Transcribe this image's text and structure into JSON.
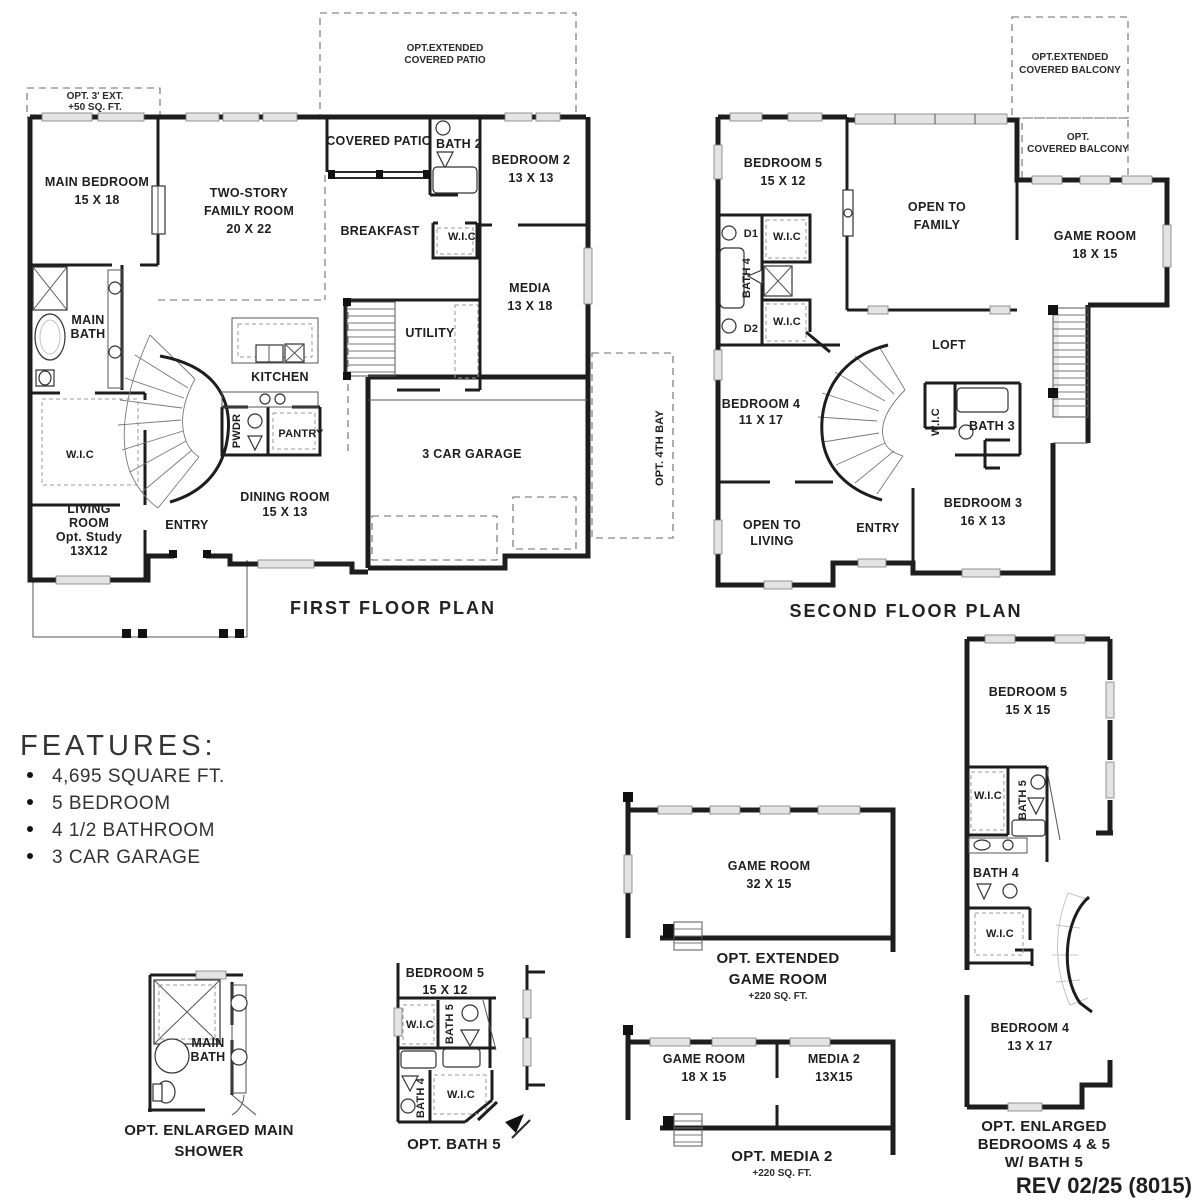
{
  "sheet": {
    "revision": "REV 02/25 (8015)",
    "wall_color": "#1d1d1d",
    "bg_color": "#ffffff"
  },
  "features": {
    "heading": "FEATURES:",
    "items": [
      "4,695 SQUARE FT.",
      "5 BEDROOM",
      "4 1/2 BATHROOM",
      "3 CAR GARAGE"
    ]
  },
  "first_floor": {
    "title": "FIRST FLOOR PLAN",
    "opt_ext": {
      "l1": "OPT. 3' EXT.",
      "l2": "+50 SQ. FT."
    },
    "opt_patio": {
      "l1": "OPT.EXTENDED",
      "l2": "COVERED PATIO"
    },
    "covered_patio": "COVERED PATIO",
    "bath2": "BATH 2",
    "bedroom2": {
      "name": "BEDROOM 2",
      "dim": "13 X 13"
    },
    "main_bedroom": {
      "name": "MAIN BEDROOM",
      "dim": "15 X 18"
    },
    "family_room": {
      "l1": "TWO-STORY",
      "l2": "FAMILY ROOM",
      "dim": "20 X 22"
    },
    "breakfast": "BREAKFAST",
    "wic_bed2": "W.I.C",
    "media": {
      "name": "MEDIA",
      "dim": "13 X 18"
    },
    "utility": "UTILITY",
    "main_bath": {
      "l1": "MAIN",
      "l2": "BATH"
    },
    "kitchen": "KITCHEN",
    "pwdr": "PWDR",
    "pantry": "PANTRY",
    "wic_main": "W.I.C",
    "living": {
      "l1": "LIVING",
      "l2": "ROOM",
      "l3": "Opt. Study",
      "l4": "13X12"
    },
    "entry": "ENTRY",
    "dining": {
      "name": "DINING ROOM",
      "dim": "15 X 13"
    },
    "garage": "3 CAR GARAGE",
    "opt_4th_bay": "OPT. 4TH BAY"
  },
  "second_floor": {
    "title": "SECOND FLOOR PLAN",
    "opt_ext_balcony": {
      "l1": "OPT.EXTENDED",
      "l2": "COVERED BALCONY"
    },
    "opt_balcony": {
      "l1": "OPT.",
      "l2": "COVERED BALCONY"
    },
    "bedroom5": {
      "name": "BEDROOM 5",
      "dim": "15 X 12"
    },
    "open_family": {
      "l1": "OPEN TO",
      "l2": "FAMILY"
    },
    "game_room": {
      "name": "GAME ROOM",
      "dim": "18 X 15"
    },
    "d1": "D1",
    "d2": "D2",
    "bath4": "BATH 4",
    "wic_top": "W.I.C",
    "wic_bottom": "W.I.C",
    "loft": "LOFT",
    "bedroom4": {
      "name": "BEDROOM 4",
      "dim": "11 X 17"
    },
    "open_living": {
      "l1": "OPEN TO",
      "l2": "LIVING"
    },
    "entry": "ENTRY",
    "wic_bed3": "W.I.C",
    "bath3": "BATH 3",
    "bedroom3": {
      "name": "BEDROOM 3",
      "dim": "16 X 13"
    }
  },
  "opt_main_shower": {
    "main_bath": {
      "l1": "MAIN",
      "l2": "BATH"
    },
    "caption": {
      "l1": "OPT. ENLARGED MAIN",
      "l2": "SHOWER"
    }
  },
  "opt_bath5": {
    "bedroom5": {
      "name": "BEDROOM 5",
      "dim": "15 X 12"
    },
    "wic_top": "W.I.C",
    "bath5": "BATH 5",
    "bath4": "BATH 4",
    "wic_bottom": "W.I.C",
    "caption": "OPT. BATH 5"
  },
  "opt_ext_game": {
    "game_room": {
      "name": "GAME ROOM",
      "dim": "32 X 15"
    },
    "caption": {
      "l1": "OPT. EXTENDED",
      "l2": "GAME ROOM",
      "l3": "+220 SQ. FT."
    }
  },
  "opt_media2": {
    "game_room": {
      "name": "GAME ROOM",
      "dim": "18 X 15"
    },
    "media2": {
      "name": "MEDIA 2",
      "dim": "13X15"
    },
    "caption": {
      "l1": "OPT. MEDIA 2",
      "l2": "+220 SQ. FT."
    }
  },
  "opt_enlarged_beds": {
    "bedroom5": {
      "name": "BEDROOM 5",
      "dim": "15 X 15"
    },
    "wic_top": "W.I.C",
    "bath5": "BATH 5",
    "bath4": "BATH 4",
    "wic_bottom": "W.I.C",
    "bedroom4": {
      "name": "BEDROOM 4",
      "dim": "13 X 17"
    },
    "caption": {
      "l1": "OPT. ENLARGED",
      "l2": "BEDROOMS 4 & 5",
      "l3": "W/ BATH 5"
    }
  }
}
